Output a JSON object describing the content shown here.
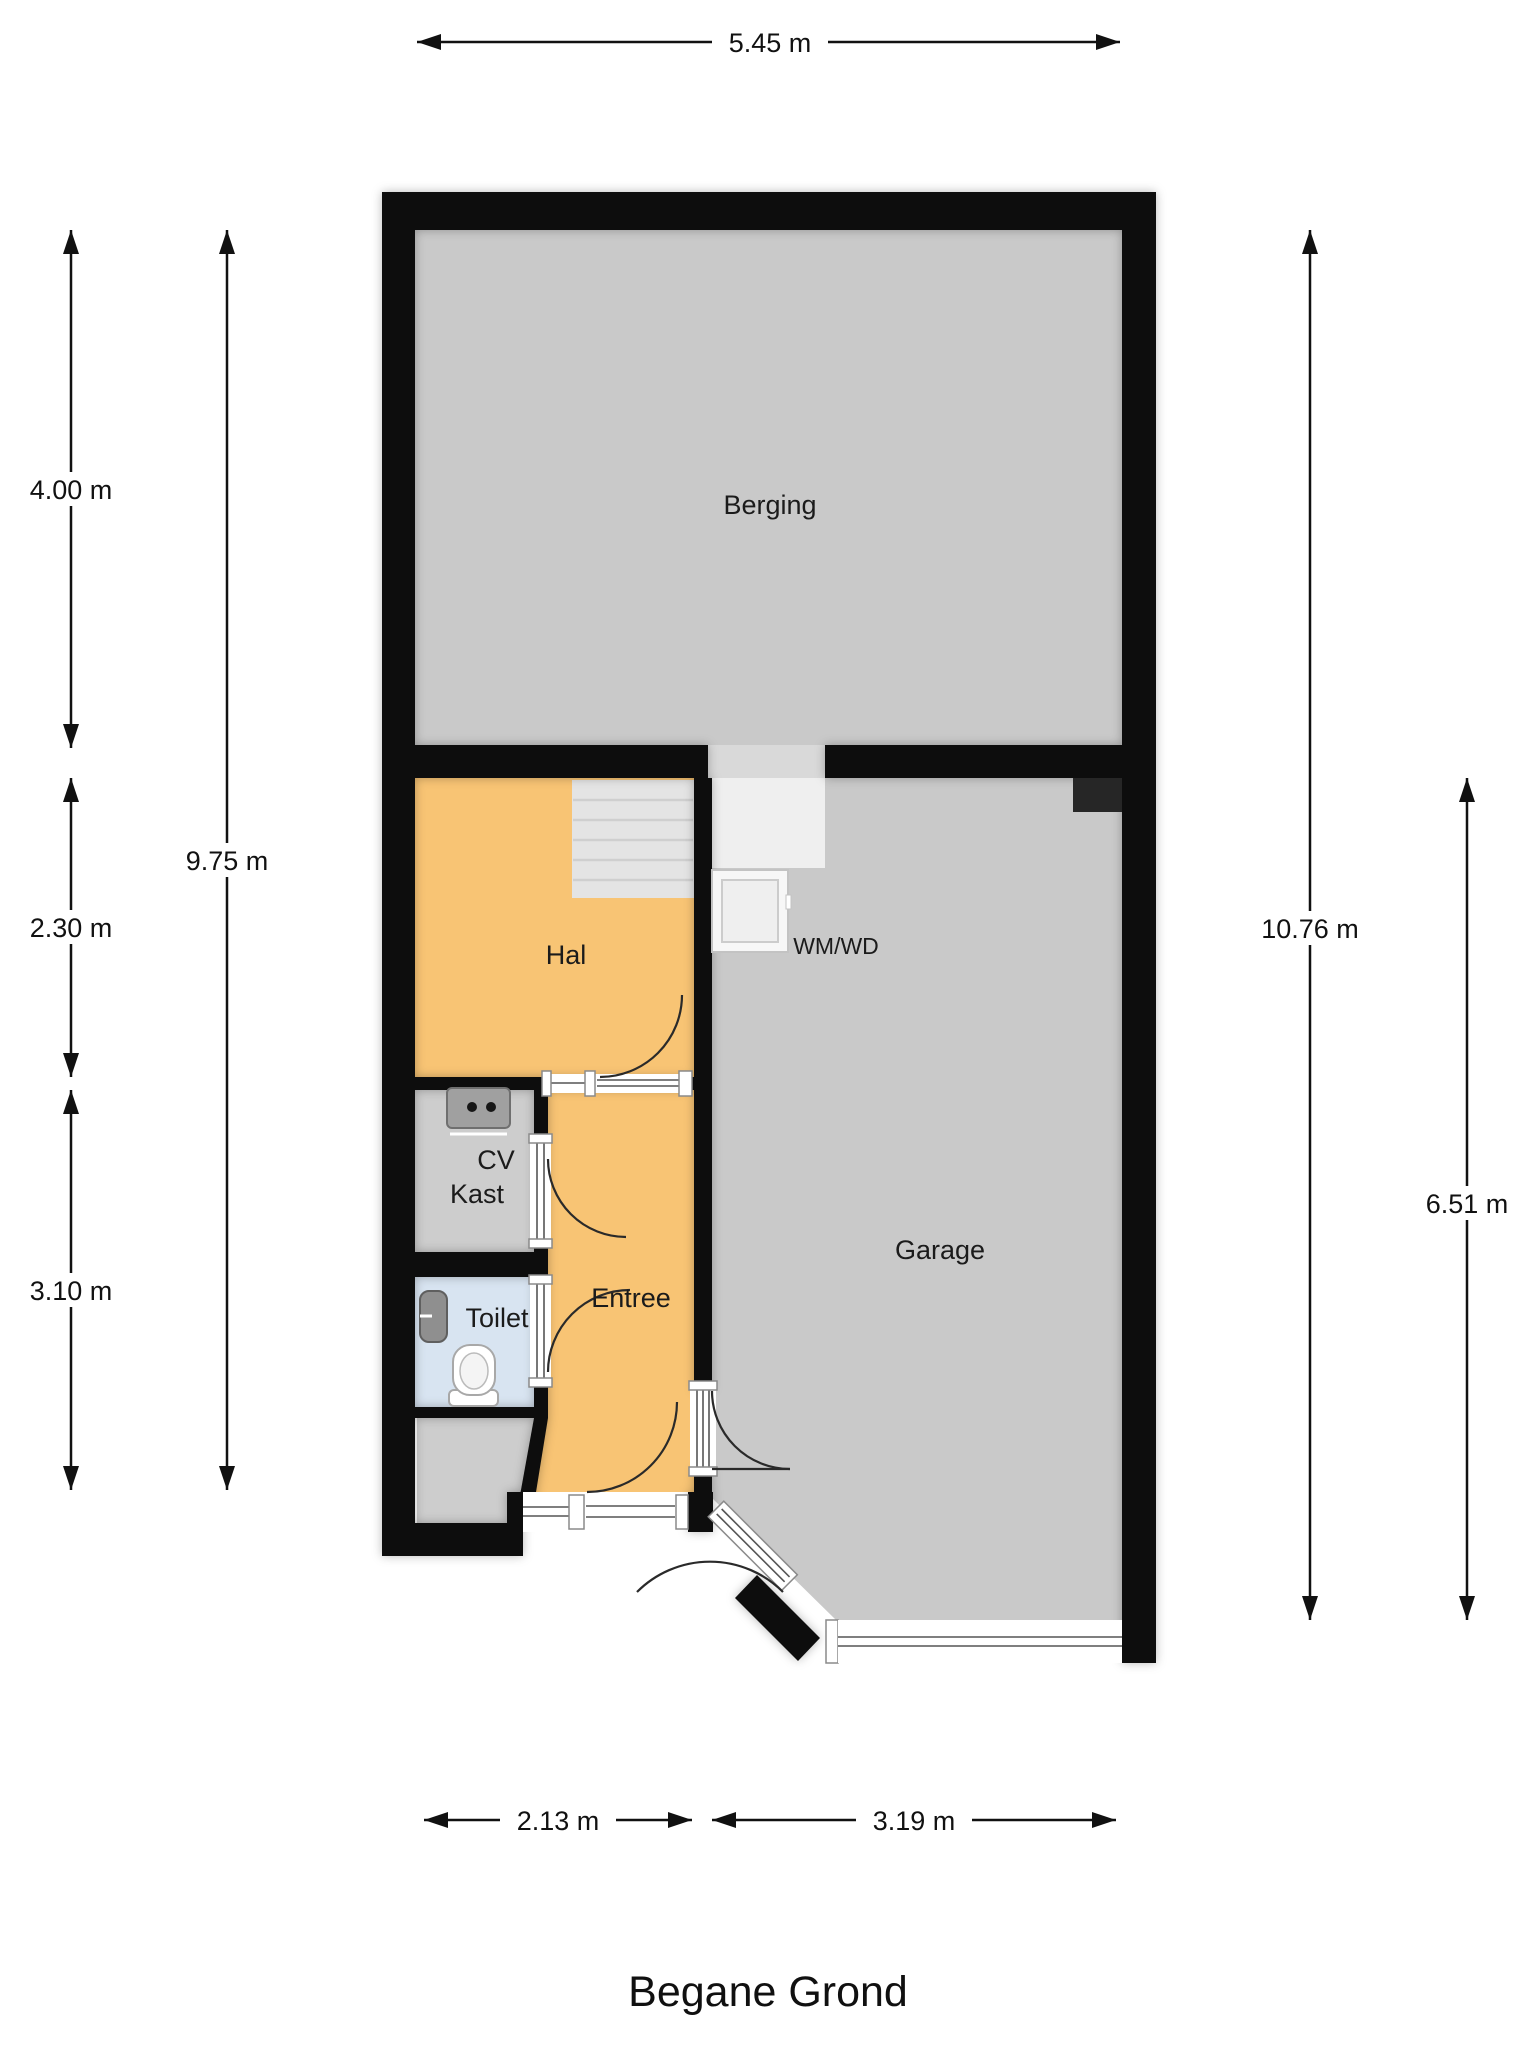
{
  "title": "Begane Grond",
  "rooms": {
    "berging": "Berging",
    "hal": "Hal",
    "cv_line1": "CV",
    "cv_line2": "Kast",
    "toilet": "Toilet",
    "entree": "Entree",
    "garage": "Garage",
    "wm_wd": "WM/WD"
  },
  "dims": {
    "top": "5.45 m",
    "left_outer": [
      "4.00 m",
      "2.30 m",
      "3.10 m"
    ],
    "left_inner": "9.75 m",
    "right_full": "10.76 m",
    "right_garage": "6.51 m",
    "bottom": [
      "2.13 m",
      "3.19 m"
    ]
  },
  "colors": {
    "wall": "#0d0d0d",
    "room_gray": "#c9c9c9",
    "closet_gray": "#cdcdcd",
    "hall_orange": "#f8c474",
    "toilet_blue": "#d8e4f1",
    "stairs_gray": "#e4e4e4",
    "landing_gray": "#efefef",
    "dark_block": "#262626",
    "background": "#ffffff"
  }
}
